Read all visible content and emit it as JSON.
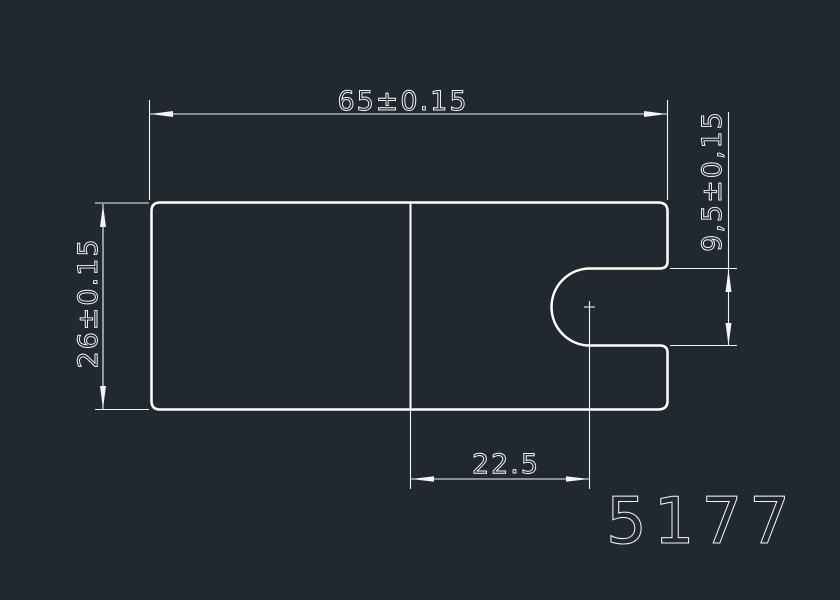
{
  "app": {
    "view_name": "cad-model-space",
    "background_color": "#222830",
    "line_color": "#ffffff"
  },
  "drawing": {
    "drawing_number": "5177",
    "dimensions": [
      {
        "name": "overall-width",
        "label": "65±0.15",
        "value": "65",
        "tolerance": "±0.15",
        "orientation": "horizontal"
      },
      {
        "name": "overall-height",
        "label": "26±0.15",
        "value": "26",
        "tolerance": "±0.15",
        "orientation": "vertical"
      },
      {
        "name": "slot-height",
        "label": "9,5±0,15",
        "value": "9,5",
        "tolerance": "±0,15",
        "orientation": "vertical"
      },
      {
        "name": "slot-center-offset",
        "label": "22.5",
        "value": "22.5",
        "tolerance": "",
        "orientation": "horizontal"
      }
    ]
  }
}
